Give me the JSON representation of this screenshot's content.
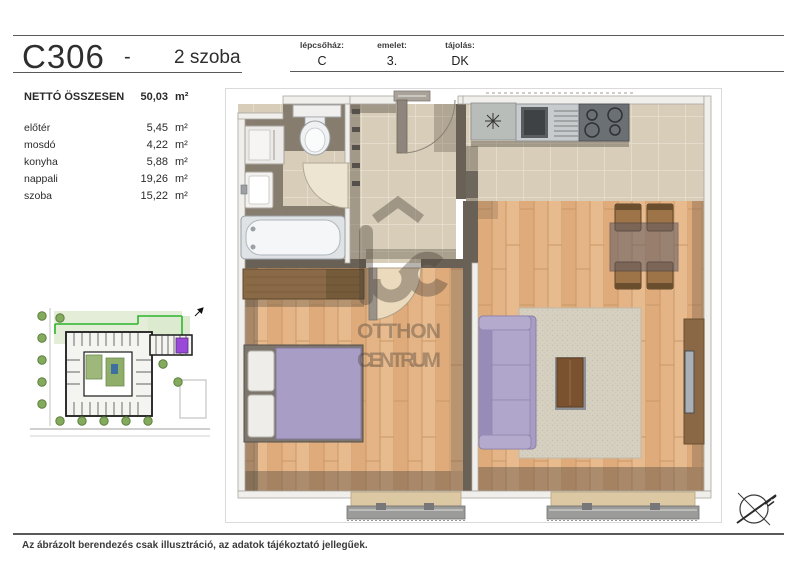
{
  "header": {
    "unit_id": "C306",
    "separator": "-",
    "unit_type": "2 szoba",
    "meta": [
      {
        "label": "lépcsőház:",
        "value": "C"
      },
      {
        "label": "emelet:",
        "value": "3."
      },
      {
        "label": "tájolás:",
        "value": "DK"
      }
    ]
  },
  "areas": {
    "total_label": "NETTÓ ÖSSZESEN",
    "total_value": "50,03",
    "unit": "m²",
    "rooms": [
      {
        "name": "előtér",
        "value": "5,45"
      },
      {
        "name": "mosdó",
        "value": "4,22"
      },
      {
        "name": "konyha",
        "value": "5,88"
      },
      {
        "name": "nappali",
        "value": "19,26"
      },
      {
        "name": "szoba",
        "value": "15,22"
      }
    ]
  },
  "watermark": {
    "line1": "OTTHON",
    "line2": "CENTRUM"
  },
  "footer": {
    "note": "Az ábrázolt berendezés csak illusztráció, az adatok tájékoztató jellegűek."
  },
  "colors": {
    "tile_floor": "#d8cdb9",
    "wood_floor": "#e4b486",
    "wall_dark": "#6a6156",
    "furniture_purple": "#a89ec5",
    "site_unit_highlight": "#9a48d8",
    "site_boundary_green": "#2db52d"
  }
}
